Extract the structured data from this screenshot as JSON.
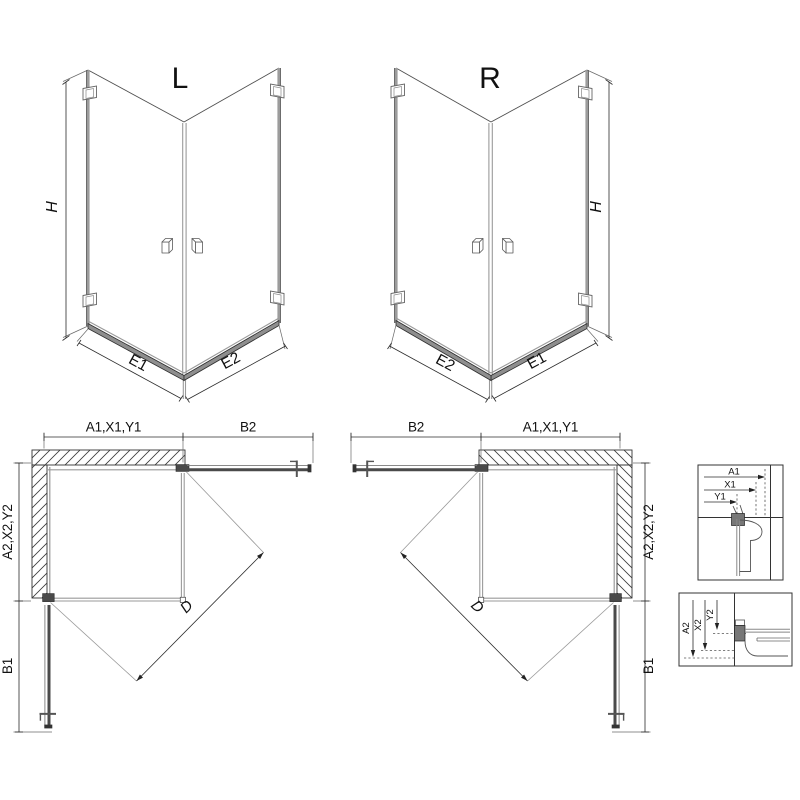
{
  "views": {
    "perspective_left": {
      "variant": "L",
      "height": "H",
      "panel_left": "E1",
      "panel_right": "E2"
    },
    "perspective_right": {
      "variant": "R",
      "height": "H",
      "panel_left": "E2",
      "panel_right": "E1"
    },
    "plan_left": {
      "wall_top": "A1,X1,Y1",
      "door_top": "B2",
      "wall_side": "A2,X2,Y2",
      "door_side": "B1",
      "diagonal": "D"
    },
    "plan_right": {
      "door_top": "B2",
      "wall_top": "A1,X1,Y1",
      "wall_side": "A2,X2,Y2",
      "door_side": "B1",
      "diagonal": "D"
    },
    "detail_wall_profile_top": {
      "dims": [
        "A1",
        "X1",
        "Y1"
      ]
    },
    "detail_wall_profile_bottom": {
      "dims": [
        "A2",
        "X2",
        "Y2"
      ]
    }
  },
  "colors": {
    "line": "#2b2b2b",
    "glass_edge": "#9a9a9a",
    "profile_dark": "#4a4a4a",
    "background": "#ffffff"
  }
}
